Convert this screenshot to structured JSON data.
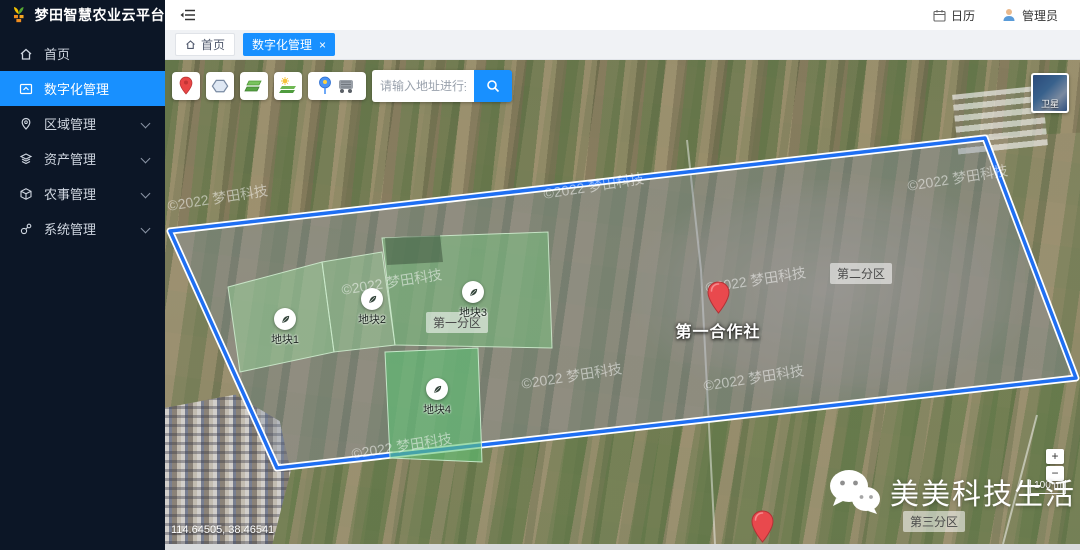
{
  "app": {
    "title": "梦田智慧农业云平台"
  },
  "header": {
    "calendar_label": "日历",
    "admin_label": "管理员"
  },
  "sidebar": {
    "items": [
      {
        "label": "首页"
      },
      {
        "label": "数字化管理"
      },
      {
        "label": "区域管理"
      },
      {
        "label": "资产管理"
      },
      {
        "label": "农事管理"
      },
      {
        "label": "系统管理"
      }
    ]
  },
  "tabs": [
    {
      "label": "首页"
    },
    {
      "label": "数字化管理",
      "close_glyph": "×"
    }
  ],
  "map": {
    "search_placeholder": "请输入地址进行搜索",
    "layer_switch_label": "卫星",
    "copyright": "©2022 梦田科技",
    "coordinates": "114.64505, 38.46541",
    "scale_label": "100 m",
    "zoom_in": "+",
    "zoom_out": "−",
    "plots": [
      {
        "label": "地块1"
      },
      {
        "label": "地块2"
      },
      {
        "label": "地块3"
      },
      {
        "label": "地块4"
      }
    ],
    "zones": [
      {
        "label": "第一分区"
      },
      {
        "label": "第二分区"
      },
      {
        "label": "第三分区"
      }
    ],
    "cooperatives": [
      {
        "label": "第一合作社"
      },
      {
        "label": "第二合作社"
      }
    ],
    "watermark_text": "美美科技生活"
  }
}
